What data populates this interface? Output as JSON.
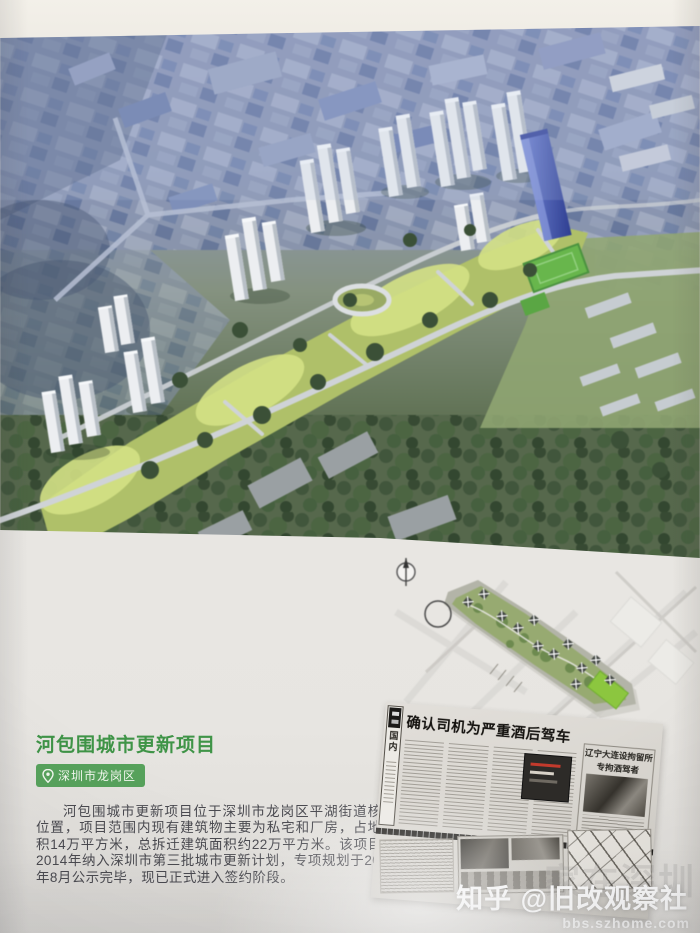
{
  "project": {
    "title": "河包围城市更新项目",
    "location": "深圳市龙岗区",
    "description": "河包围城市更新项目位于深圳市龙岗区平湖街道核心位置，项目范围内现有建筑物主要为私宅和厂房，占地面积14万平方米，总拆迁建筑面积约22万平方米。该项目于2014年纳入深圳市第三批城市更新计划，专项规划于2016年8月公示完毕，现已正式进入签约阶段。"
  },
  "newspaper": {
    "section": "国内",
    "headline": "确认司机为严重酒后驾车",
    "sidebox_line1": "辽宁大连设拘留所",
    "sidebox_line2": "专拘酒驾者"
  },
  "watermark": {
    "main": "知乎 @旧改观察社",
    "url": "bbs.szhome.com",
    "ghost": "家在深圳"
  },
  "colors": {
    "title_green": "#3f9447",
    "badge_green": "#57a25c"
  }
}
